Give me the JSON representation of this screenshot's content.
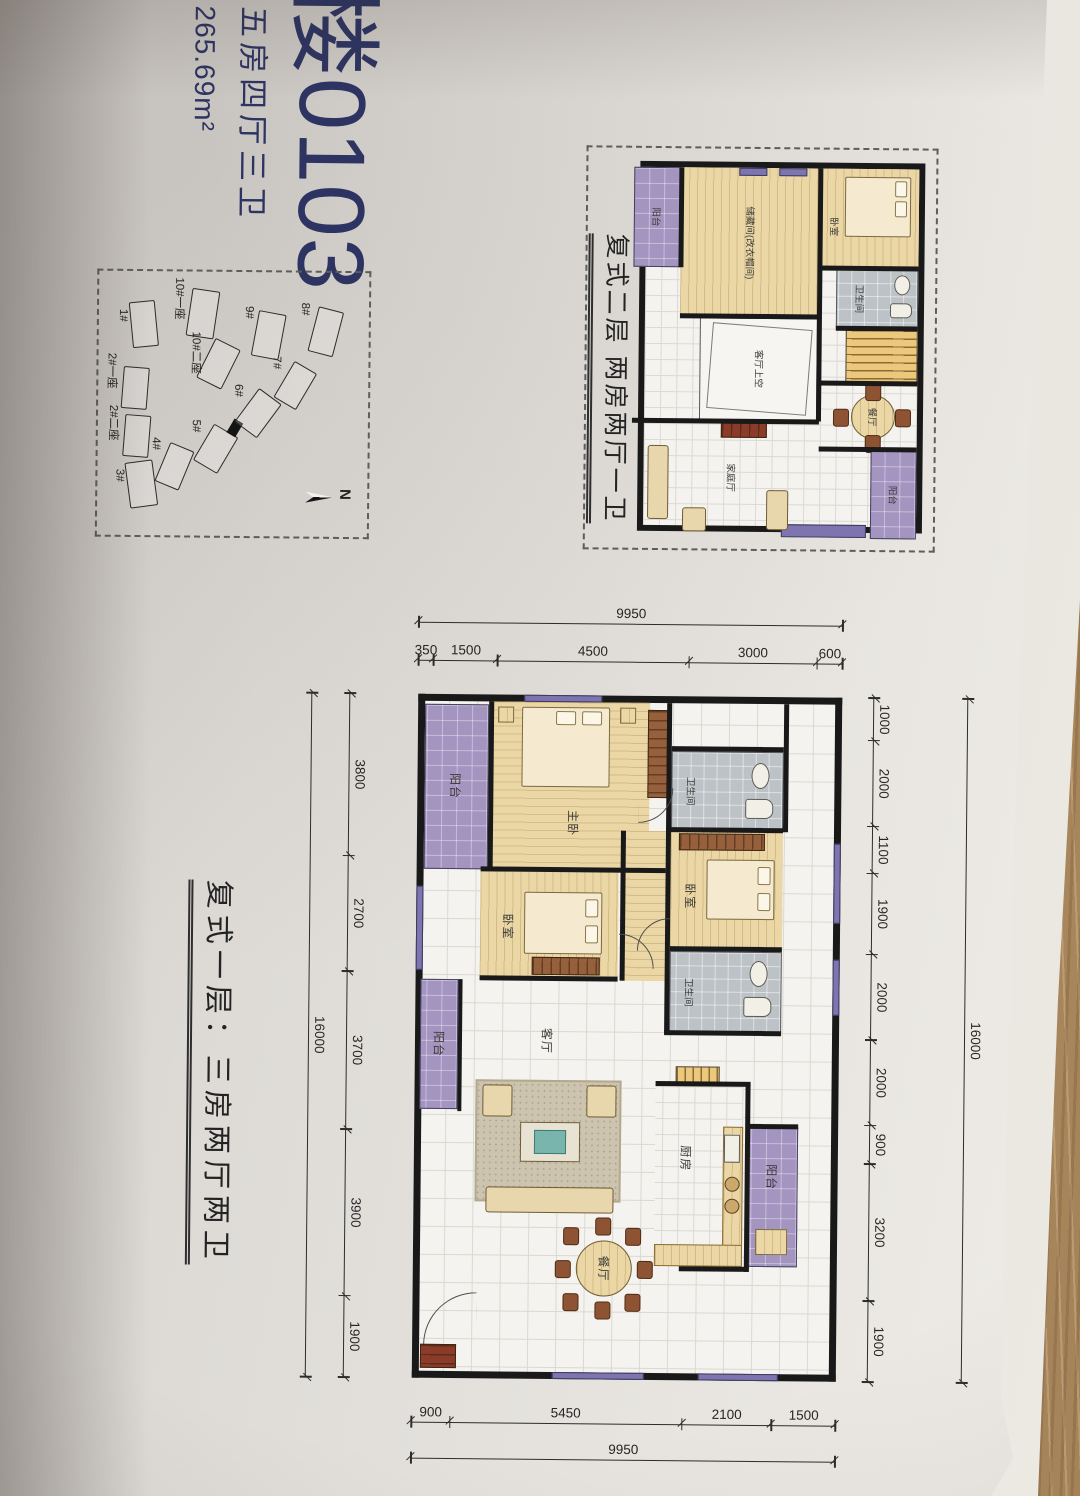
{
  "title": {
    "unit_number": "楼0103",
    "layout_type": "五房四厅三卫",
    "area": "265.69m²"
  },
  "floor2": {
    "caption": "复式二层  两房两厅一卫",
    "rooms": {
      "storage": "储藏间(改衣帽间)",
      "bedroom": "卧室",
      "bathroom": "卫生间",
      "living_void": "客厅上空",
      "dining": "餐厅",
      "family_hall": "家庭厅",
      "balcony": "阳台"
    }
  },
  "floor1": {
    "caption": "复式一层：三房两厅两卫",
    "rooms": {
      "master": "主卧",
      "bedroom": "卧室",
      "bathroom": "卫生间",
      "living": "客厅",
      "dining": "餐厅",
      "kitchen": "厨房",
      "balcony": "阳台"
    },
    "dims": {
      "top_total": "16000",
      "top_segments": [
        "1000",
        "2000",
        "1100",
        "1900",
        "2000",
        "2000",
        "900",
        "3200",
        "1900"
      ],
      "bottom_total": "16000",
      "bottom_segments": [
        "3800",
        "2700",
        "3700",
        "3900",
        "1900"
      ],
      "left_total": "9950",
      "left_segments": [
        "600",
        "3000",
        "4500",
        "1500",
        "350"
      ],
      "right_total": "9950",
      "right_segments": [
        "1500",
        "2100",
        "5450",
        "900"
      ]
    }
  },
  "site_plan": {
    "north_label": "N",
    "buildings": [
      "1#",
      "2#一座",
      "2#二座",
      "3#",
      "4#",
      "5#",
      "6#",
      "7#",
      "8#",
      "9#",
      "10#一座",
      "10#二座"
    ]
  },
  "colors": {
    "accent_blue": "#2d3462",
    "wall_black": "#191919",
    "balcony_purple": "#a494c0",
    "room_tan": "#ead7a5",
    "bath_gray": "#bcc2c6",
    "stair_yellow": "#ecc87d"
  }
}
